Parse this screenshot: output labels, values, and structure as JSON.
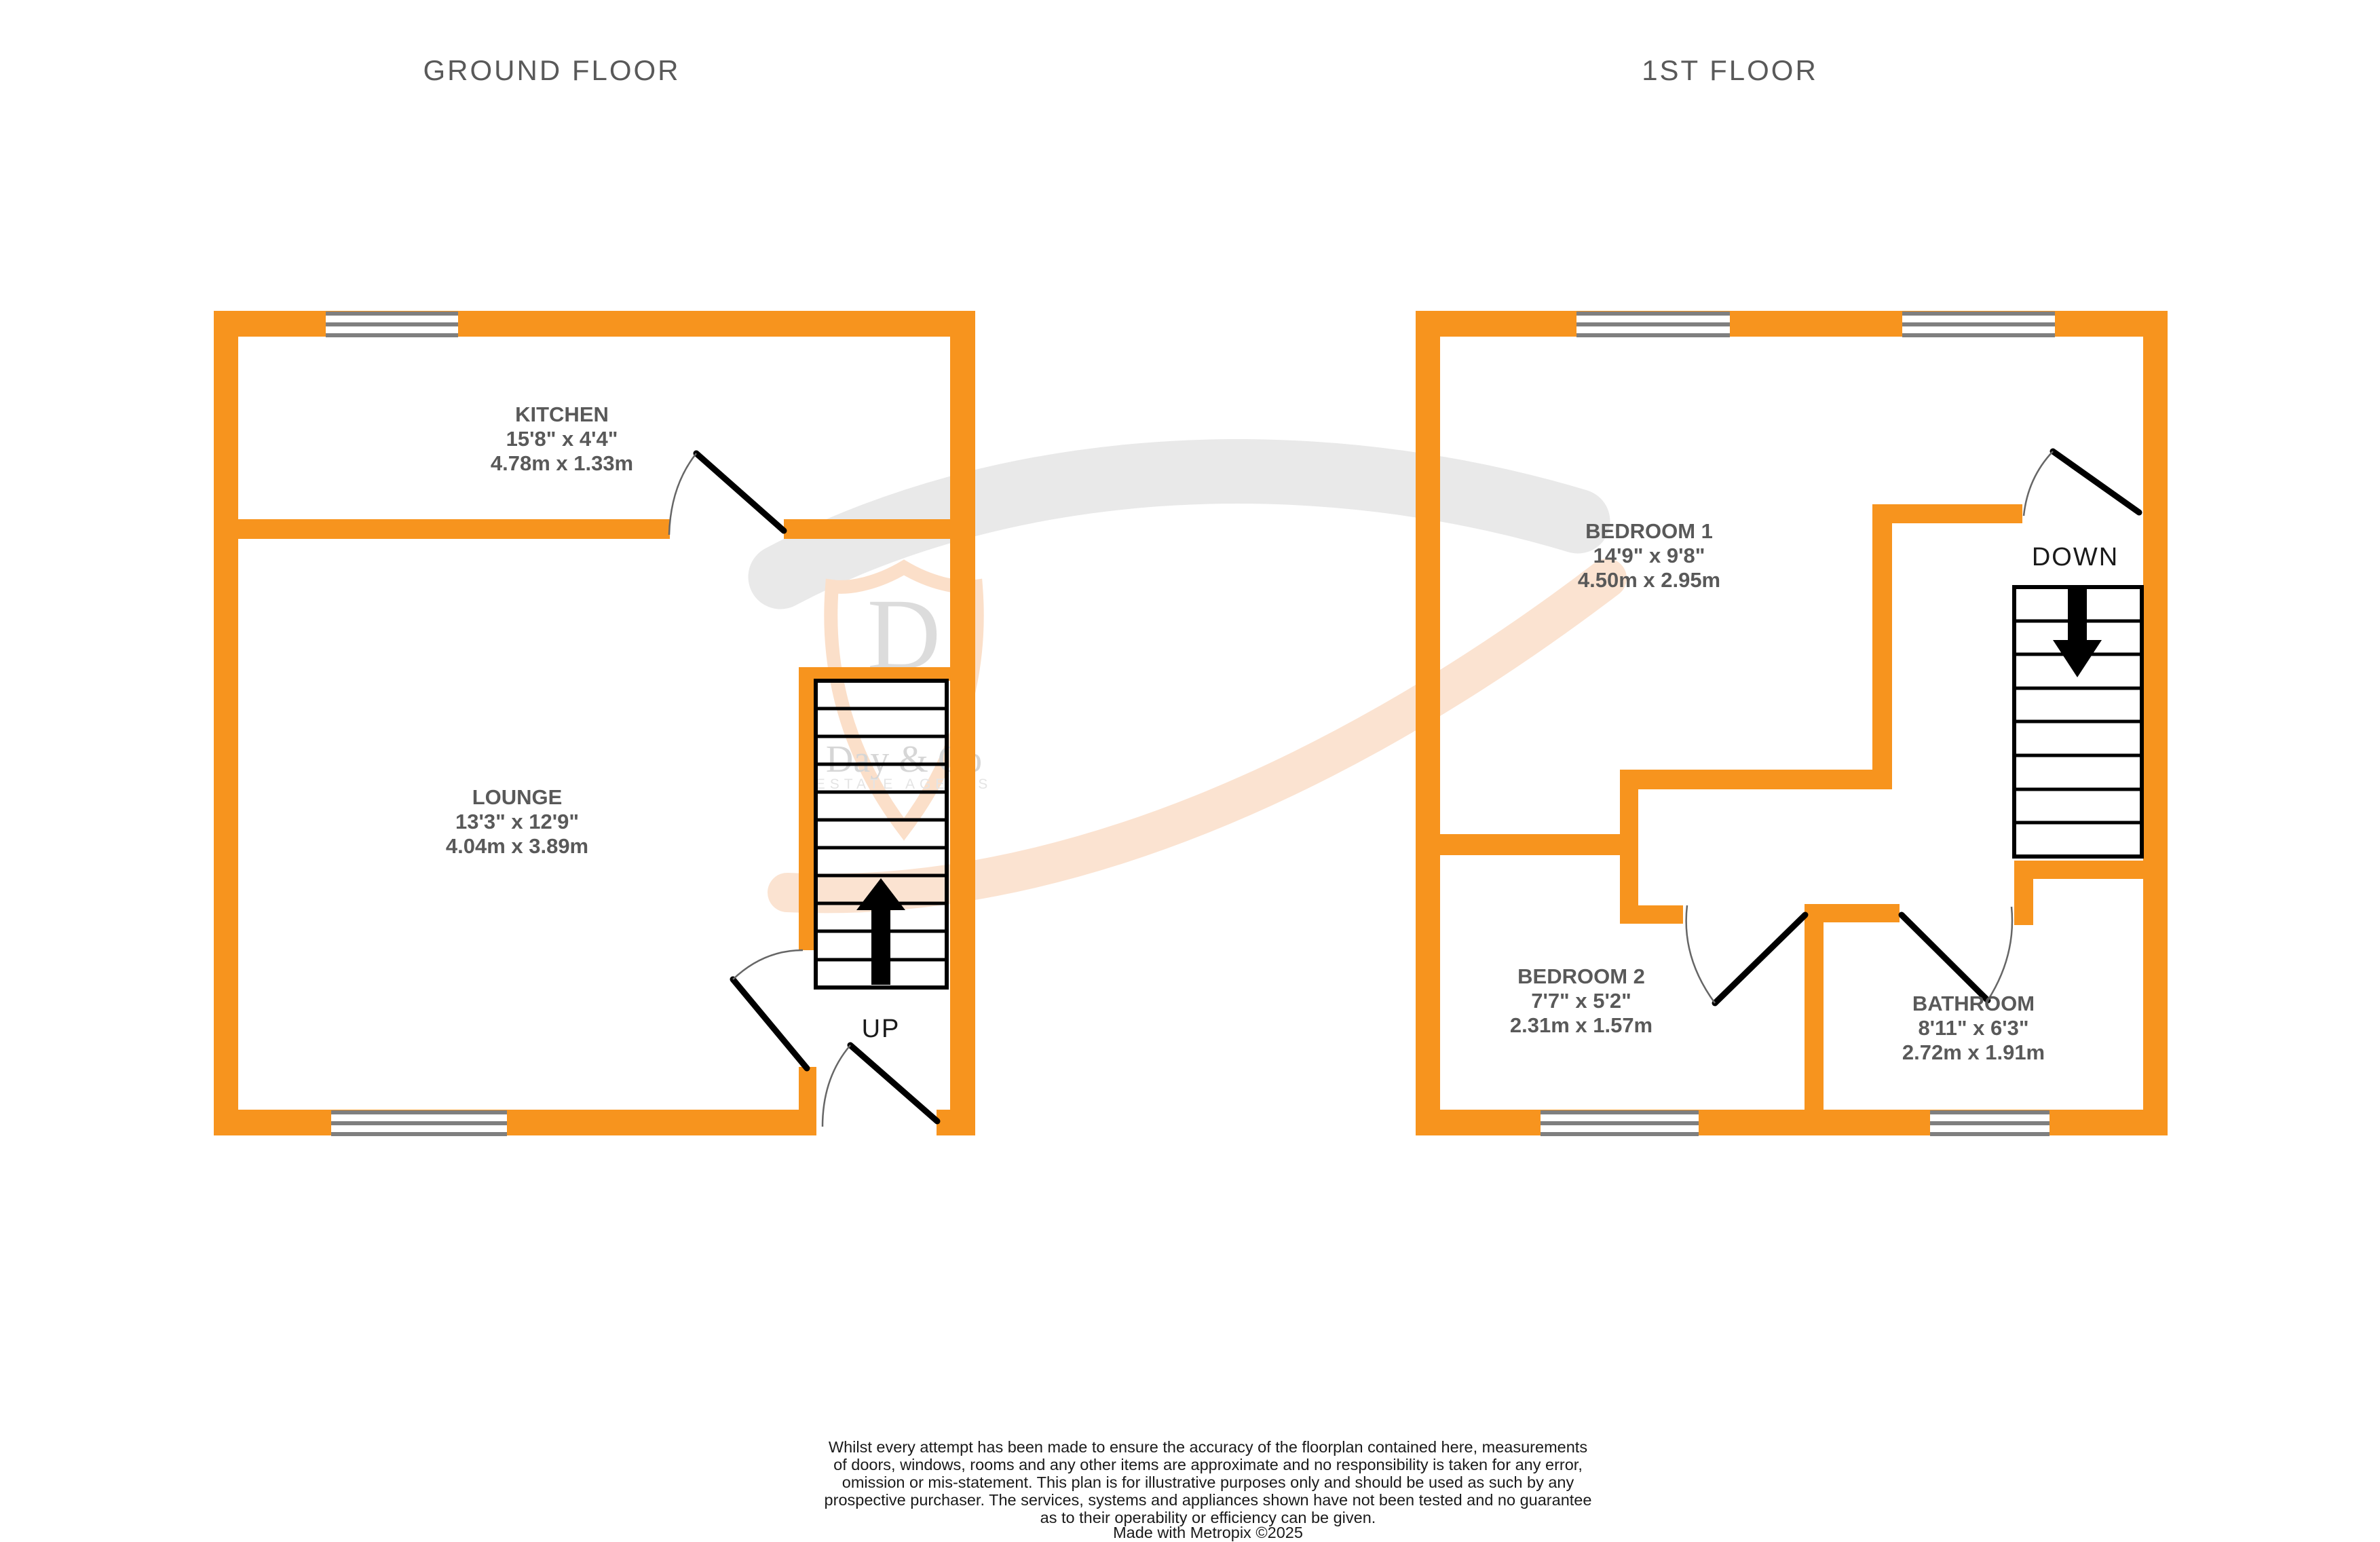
{
  "titles": {
    "left": "GROUND FLOOR",
    "right": "1ST FLOOR"
  },
  "rooms": {
    "kitchen": {
      "name": "KITCHEN",
      "imperial": "15'8\" x 4'4\"",
      "metric": "4.78m x 1.33m"
    },
    "lounge": {
      "name": "LOUNGE",
      "imperial": "13'3\" x 12'9\"",
      "metric": "4.04m x 3.89m"
    },
    "bedroom1": {
      "name": "BEDROOM 1",
      "imperial": "14'9\" x 9'8\"",
      "metric": "4.50m x 2.95m"
    },
    "bedroom2": {
      "name": "BEDROOM 2",
      "imperial": "7'7\" x 5'2\"",
      "metric": "2.31m x 1.57m"
    },
    "bathroom": {
      "name": "BATHROOM",
      "imperial": "8'11\" x 6'3\"",
      "metric": "2.72m x 1.91m"
    }
  },
  "stairs": {
    "up_label": "UP",
    "down_label": "DOWN"
  },
  "watermark": {
    "initial": "D",
    "name": "Day & Co",
    "tagline": "ESTATE AGENTS"
  },
  "disclaimer": {
    "lines": [
      "Whilst every attempt has been made to ensure the accuracy of the floorplan contained here, measurements",
      "of doors, windows, rooms and any other items are approximate and no responsibility is taken for any error,",
      "omission or mis-statement. This plan is for illustrative purposes only and should be used as such by any",
      "prospective purchaser. The services, systems and appliances shown have not been tested and no guarantee",
      "as to their operability or efficiency can be given.",
      "Made with Metropix ©2025"
    ]
  },
  "colors": {
    "wall": "#F7941E",
    "label": "#595959",
    "window_frame": "#7F7F7F",
    "watermark_gray": "#E9E9E9",
    "watermark_peach": "#FBE3D1",
    "watermark_shield": "#FBDFC9"
  }
}
